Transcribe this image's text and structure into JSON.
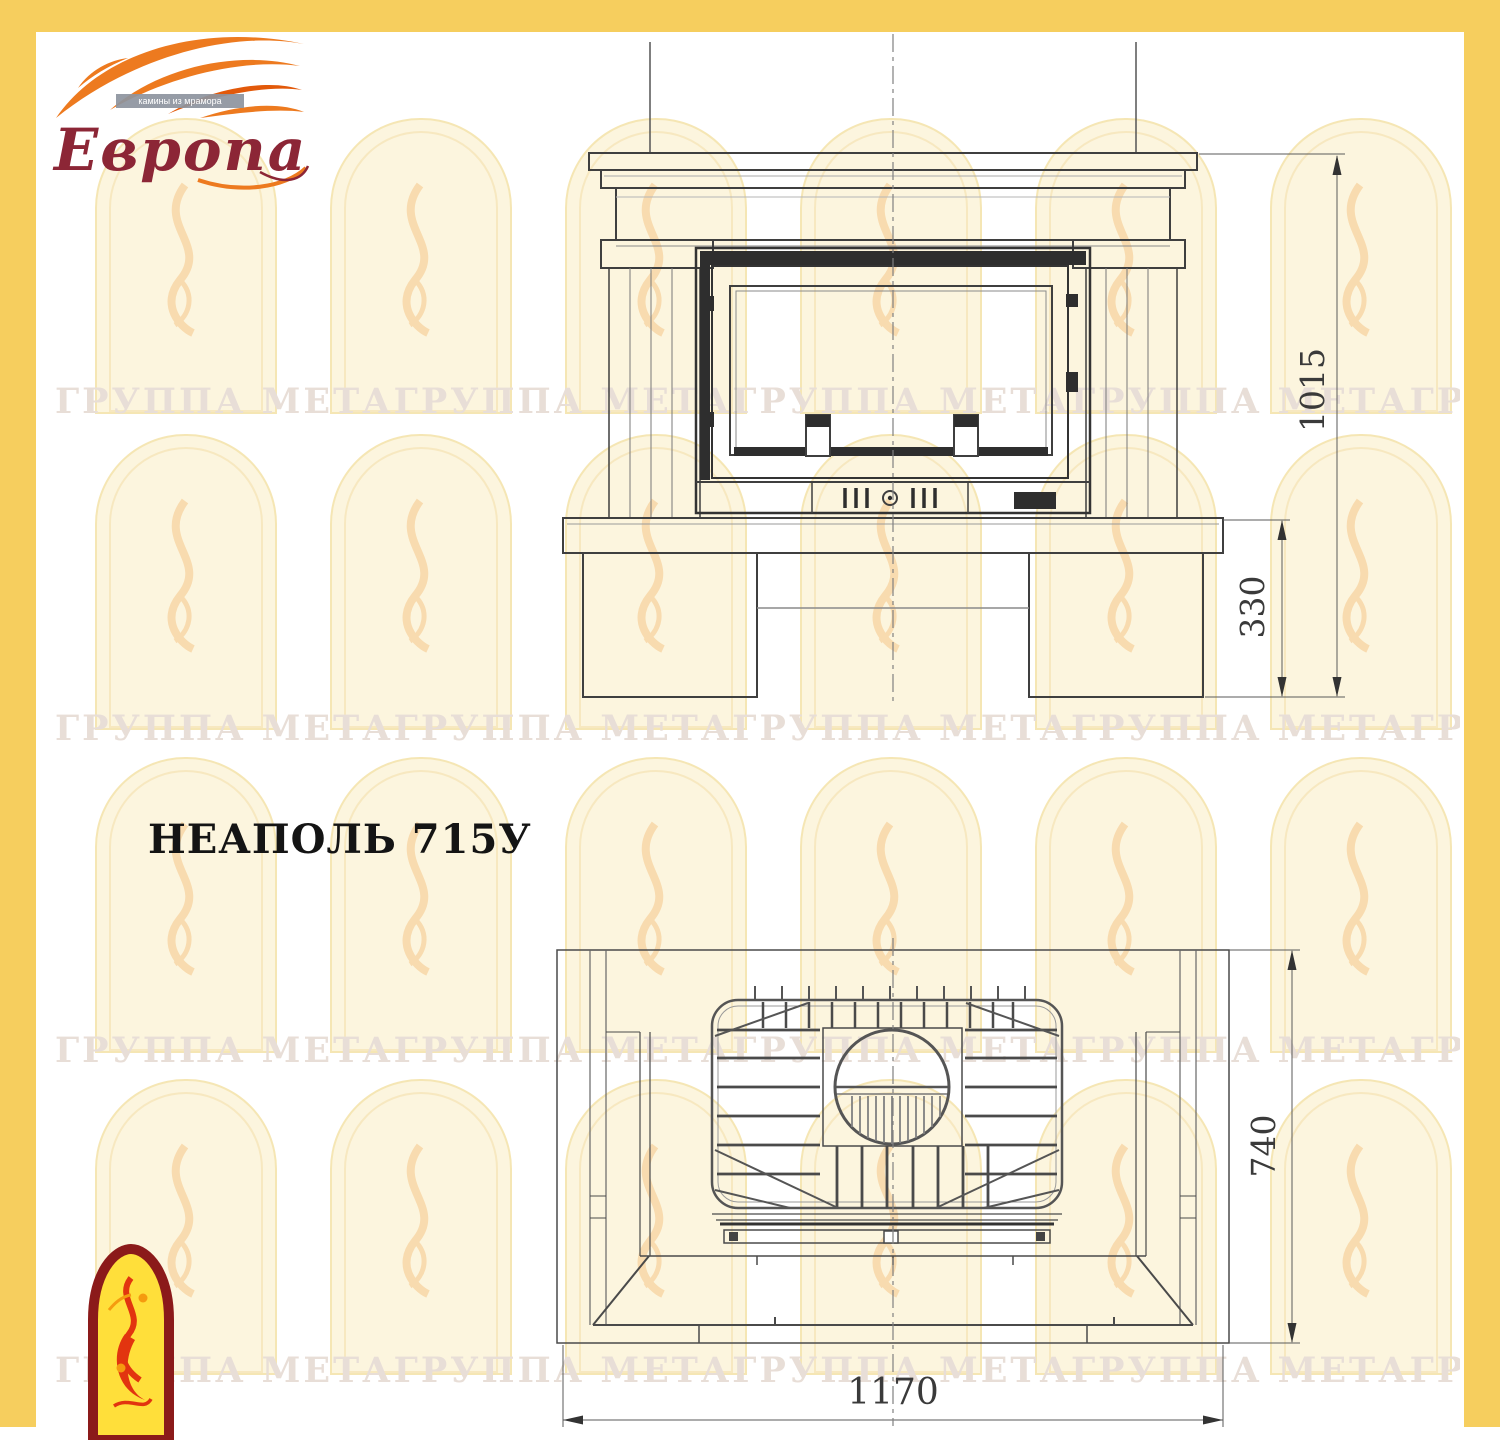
{
  "page": {
    "background": "#ffffff",
    "frame_color": "#F6CE5E"
  },
  "header_logo": {
    "brand": "Европа",
    "tagline": "камины из мрамора",
    "flame_color": "#ED7A1F",
    "brand_color": "#8C2636"
  },
  "title": "НЕАПОЛЬ 715У",
  "front_view": {
    "dim_height_total": "1015",
    "dim_height_base": "330"
  },
  "plan_view": {
    "dim_depth": "740",
    "dim_width": "1170"
  },
  "watermark": {
    "text": "ГРУППА МЕТАГРУППА МЕТАГРУППА МЕТАГРУППА МЕТАГРУППА МЕТА",
    "text_color": "#e8ded7",
    "text_rows_y": [
      381,
      708,
      1030,
      1350
    ],
    "arch_cols_x": [
      95,
      330,
      565,
      800,
      1035,
      1270
    ],
    "arch_rows_y": [
      118,
      434,
      757,
      1079
    ],
    "arch_fill": "#FBF3D8",
    "arch_line": "#F5E4B0",
    "bird_color": "#F5C689"
  },
  "drawing": {
    "line_color": "#3f3f3f",
    "dim_color": "#3a3a3a"
  }
}
